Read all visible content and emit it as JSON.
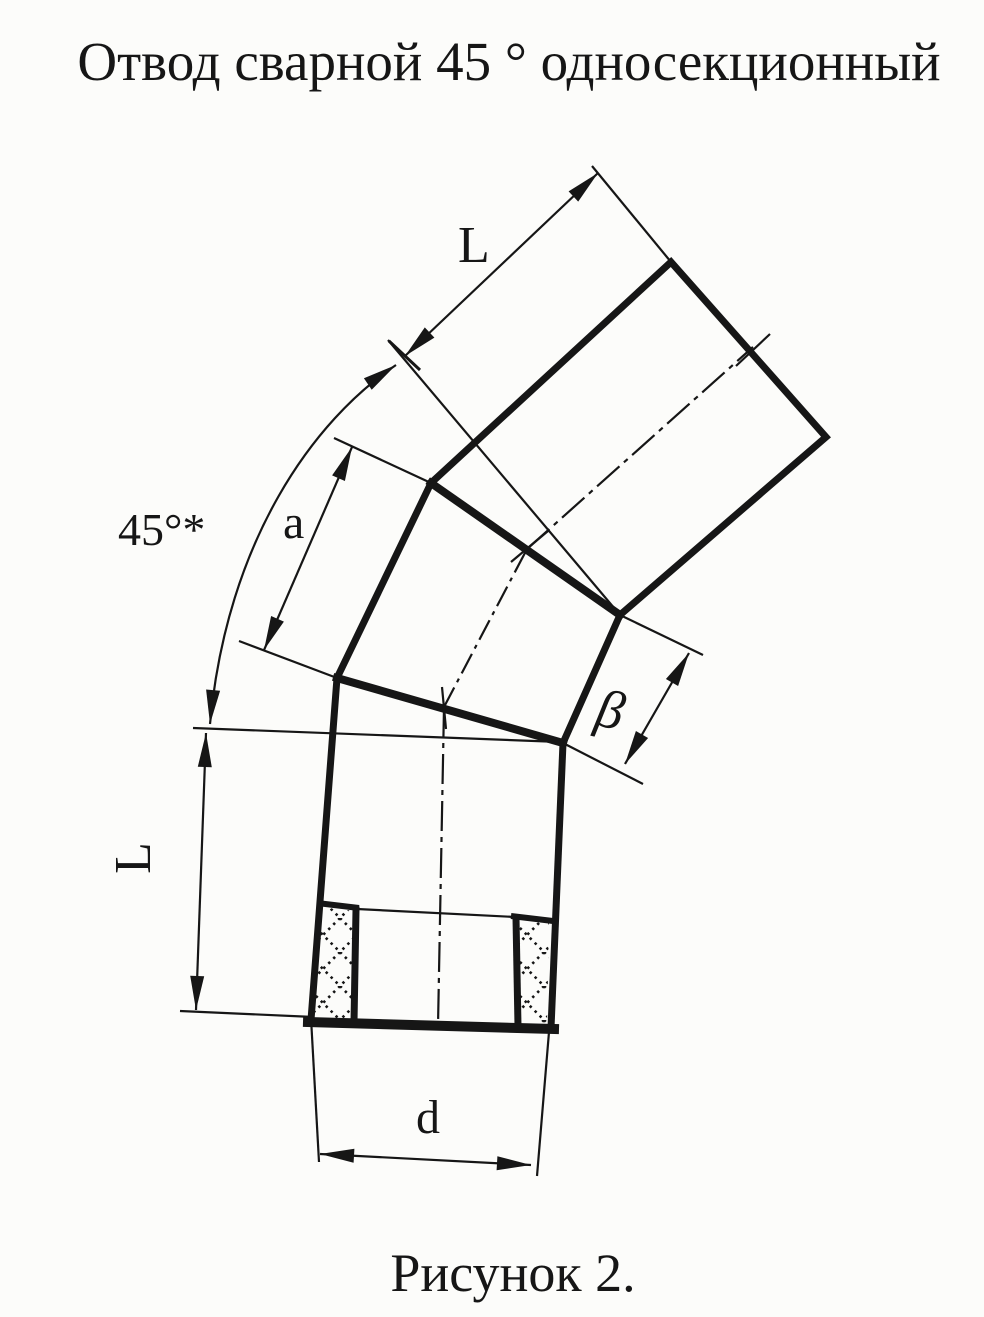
{
  "title": "Отвод сварной 45 ° односекционный",
  "caption": "Рисунок 2.",
  "colors": {
    "ink": "#161616",
    "paper": "#fcfcfa"
  },
  "drawing_labels": {
    "upper_pipe_length": "L",
    "middle_section_length": "a",
    "bend_angle": "45°*",
    "lower_pipe_length": "L",
    "bore_diameter": "d",
    "section_end_width": "β"
  }
}
